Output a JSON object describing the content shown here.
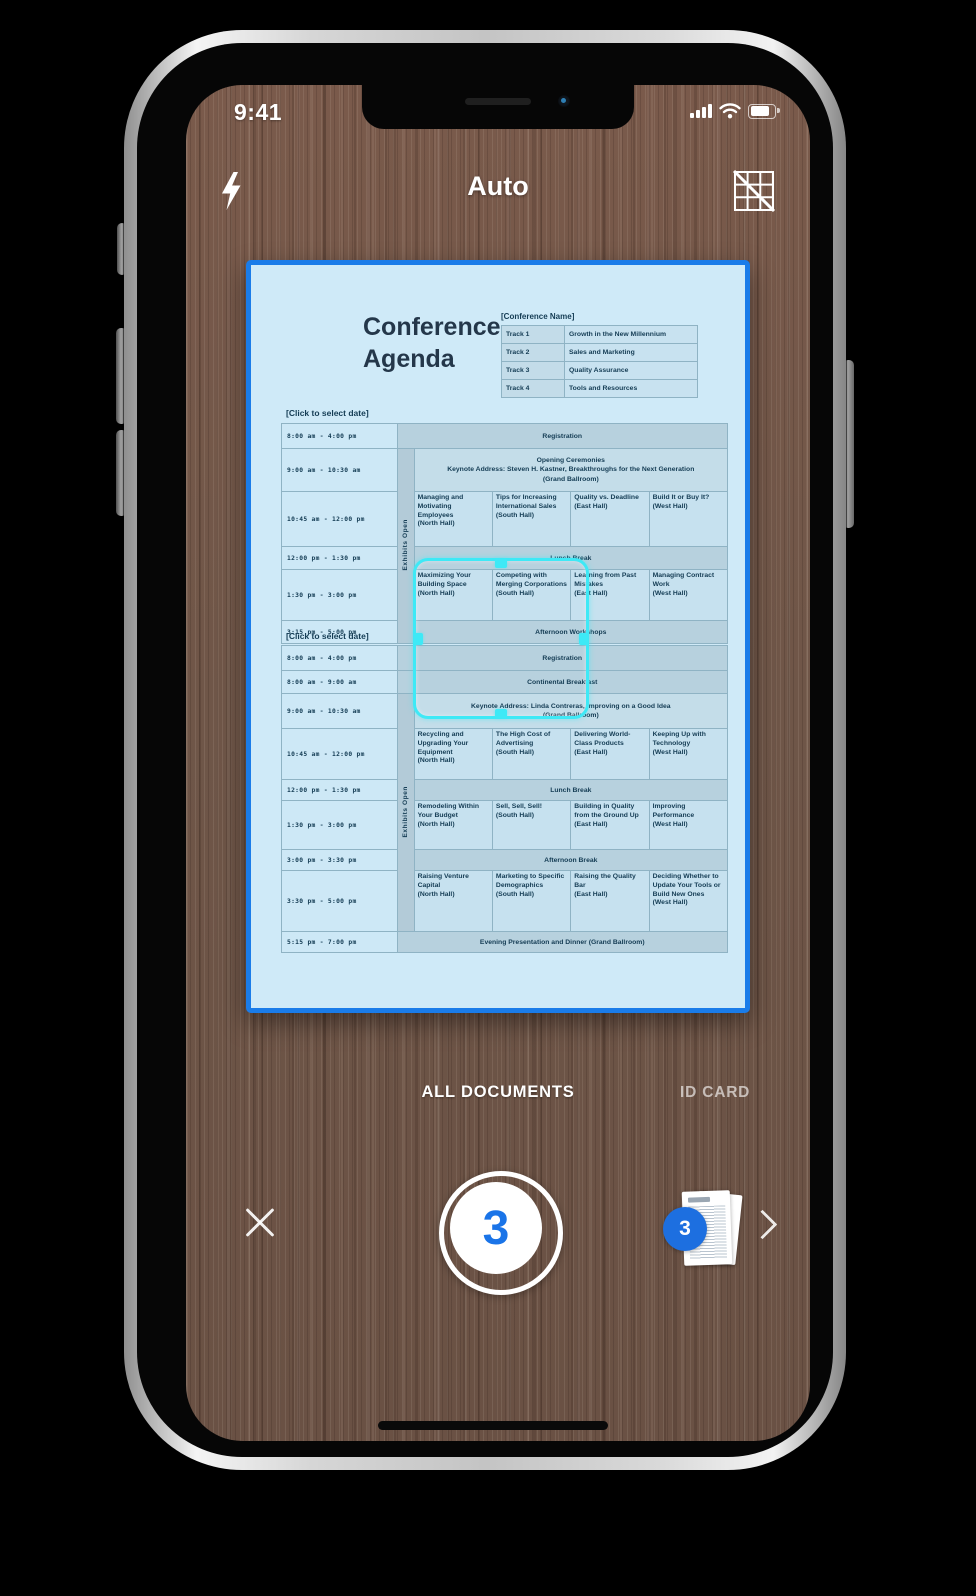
{
  "status_bar": {
    "time": "9:41"
  },
  "toolbar": {
    "mode": "Auto"
  },
  "document": {
    "title": "Conference\nAgenda",
    "conference_name_header": "[Conference Name]",
    "tracks": [
      {
        "label": "Track 1",
        "value": "Growth in the New Millennium"
      },
      {
        "label": "Track 2",
        "value": "Sales and Marketing"
      },
      {
        "label": "Track 3",
        "value": "Quality Assurance"
      },
      {
        "label": "Track 4",
        "value": "Tools and Resources"
      }
    ],
    "day1": {
      "date_label": "[Click to select date]",
      "exhibits_label": "Exhibits Open",
      "rows": [
        {
          "time": "8:00 am - 4:00 pm",
          "label": "Registration"
        },
        {
          "time": "9:00 am - 10:30 am",
          "text": "Opening Ceremonies\nKeynote Address: Steven H. Kastner, Breakthroughs for the Next Generation\n(Grand Ballroom)"
        },
        {
          "time": "10:45 am - 12:00 pm",
          "cells": [
            "Managing and Motivating Employees\n(North Hall)",
            "Tips for Increasing International Sales\n(South Hall)",
            "Quality vs. Deadline\n(East Hall)",
            "Build It or Buy It?\n(West Hall)"
          ]
        },
        {
          "time": "12:00 pm - 1:30 pm",
          "label": "Lunch Break"
        },
        {
          "time": "1:30 pm - 3:00 pm",
          "cells": [
            "Maximizing Your Building Space\n(North Hall)",
            "Competing with Merging Corporations\n(South Hall)",
            "Learning from Past Mistakes\n(East Hall)",
            "Managing Contract Work\n(West Hall)"
          ]
        },
        {
          "time": "3:15 pm - 5:00 pm",
          "label": "Afternoon Workshops"
        }
      ]
    },
    "day2": {
      "date_label": "[Click to select date]",
      "exhibits_label": "Exhibits Open",
      "rows": [
        {
          "time": "8:00 am - 4:00 pm",
          "label": "Registration"
        },
        {
          "time": "8:00 am - 9:00 am",
          "label": "Continental Breakfast"
        },
        {
          "time": "9:00 am - 10:30 am",
          "text": "Keynote Address: Linda Contreras, Improving on a Good Idea\n(Grand Ballroom)"
        },
        {
          "time": "10:45 am - 12:00 pm",
          "cells": [
            "Recycling and Upgrading Your Equipment\n(North Hall)",
            "The High Cost of Advertising\n(South Hall)",
            "Delivering World-Class Products\n(East Hall)",
            "Keeping Up with Technology\n(West Hall)"
          ]
        },
        {
          "time": "12:00 pm - 1:30 pm",
          "label": "Lunch Break"
        },
        {
          "time": "1:30 pm - 3:00 pm",
          "cells": [
            "Remodeling Within Your Budget\n(North Hall)",
            "Sell, Sell, Sell!\n(South Hall)",
            "Building in Quality from the Ground Up\n(East Hall)",
            "Improving Performance\n(West Hall)"
          ]
        },
        {
          "time": "3:00 pm - 3:30 pm",
          "label": "Afternoon Break"
        },
        {
          "time": "3:30 pm - 5:00 pm",
          "cells": [
            "Raising Venture Capital\n(North Hall)",
            "Marketing to Specific Demographics\n(South Hall)",
            "Raising the Quality Bar\n(East Hall)",
            "Deciding Whether to Update Your Tools or Build New Ones\n(West Hall)"
          ]
        },
        {
          "time": "5:15 pm - 7:00 pm",
          "label": "Evening Presentation and Dinner (Grand Ballroom)"
        }
      ]
    }
  },
  "mode_tabs": {
    "all_documents": "ALL DOCUMENTS",
    "id_card": "ID CARD"
  },
  "shutter": {
    "count": "3"
  },
  "thumbnail": {
    "badge_count": "3"
  },
  "colors": {
    "document_highlight_border": "#1a7ce9",
    "document_tint": "#cfeaf8",
    "focus_frame_cyan": "#3ee9f6",
    "shutter_count_blue": "#1a74e8",
    "badge_blue": "#1d6fe0"
  }
}
